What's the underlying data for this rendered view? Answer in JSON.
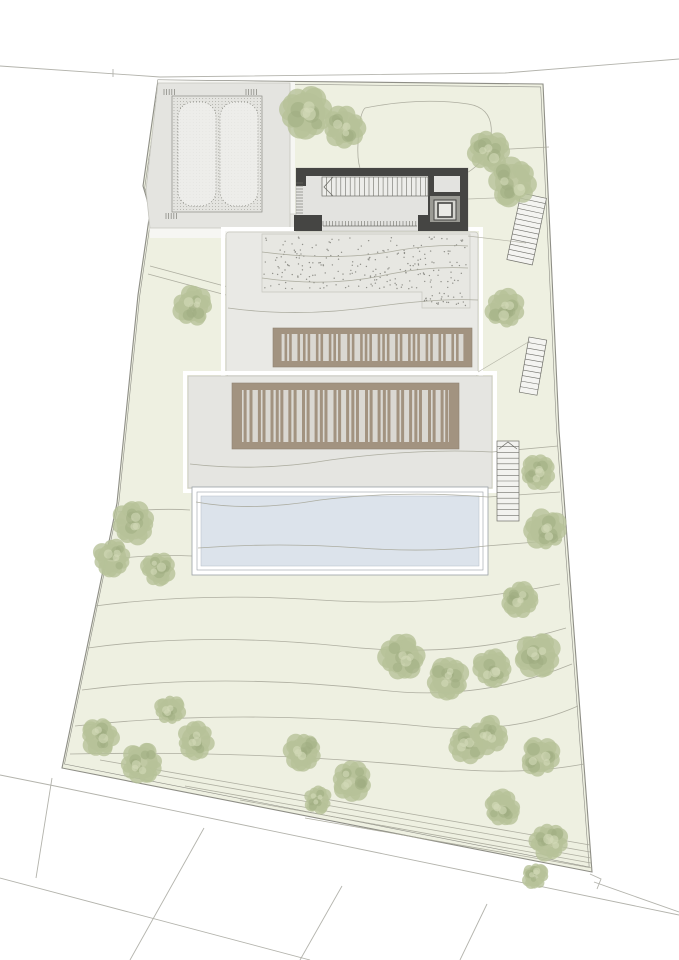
{
  "title": "architectural-site-plan",
  "canvas": {
    "width": 679,
    "height": 960
  },
  "seed": 7,
  "palette": {
    "paper": "#ffffff",
    "lawn": "#eef0e1",
    "hardscape": "#f6f6f3",
    "boundary": "#8e8e86",
    "contour": "#a6a699",
    "road": "#b3b3ac",
    "terrace": "#e9e9e5",
    "terraceB": "#e5e5e1",
    "terraceStroke": "#c6c6bf",
    "stippleDot": "#90908a",
    "parkingFill": "#e4e4e0",
    "parkingLine": "#8c8c85",
    "deckFrame": "#a29380",
    "deckBed": "#dad8d2",
    "poolFill": "#dce3eb",
    "poolLine": "#9aa0a6",
    "wall": "#454543",
    "floor": "#e3e3e0",
    "detail": "#70706a",
    "treeMid": "#b7c298",
    "treeDark": "#9dac7f",
    "treeLight": "#d3dbb9"
  },
  "site": {
    "boundary": [
      [
        158,
        80
      ],
      [
        543,
        84
      ],
      [
        551,
        255
      ],
      [
        559,
        430
      ],
      [
        572,
        605
      ],
      [
        592,
        872
      ],
      [
        62,
        768
      ],
      [
        117,
        503
      ],
      [
        138,
        295
      ],
      [
        150,
        212
      ],
      [
        146,
        196
      ],
      [
        143,
        186
      ]
    ],
    "innerScale": 0.99
  },
  "roads": {
    "top": [
      "M0,66 L160,77 L505,73 L679,59",
      "M113,69 L113,77"
    ],
    "bottom": [
      "M0,775 L50,785 L679,915",
      "M0,878 L310,960",
      "M52,778 L36,878",
      "M204,828 L130,960",
      "M342,886 L300,960",
      "M487,904 L460,960",
      "M594,882 L679,912",
      "M590,874 L601,879 L597,889"
    ]
  },
  "hardscapeZone": [
    [
      146,
      186
    ],
    [
      158,
      80
    ],
    [
      295,
      82
    ],
    [
      295,
      238
    ],
    [
      150,
      238
    ]
  ],
  "parking": {
    "platform": [
      [
        158,
        83
      ],
      [
        290,
        83
      ],
      [
        290,
        228
      ],
      [
        150,
        228
      ],
      [
        146,
        190
      ]
    ],
    "grid": {
      "x": 172,
      "y": 96,
      "w": 90,
      "h": 116,
      "step": 3.2
    },
    "beds": [
      [
        178,
        102,
        38,
        104
      ],
      [
        220,
        102,
        38,
        104
      ]
    ],
    "combs": [
      {
        "x": 164,
        "y": 89,
        "n": 5
      },
      {
        "x": 246,
        "y": 89,
        "n": 5
      },
      {
        "x": 166,
        "y": 213,
        "n": 5
      }
    ]
  },
  "connector": {
    "x": 262,
    "y": 214,
    "w": 34,
    "h": 16
  },
  "terraceA": {
    "x": 226,
    "y": 232,
    "w": 252,
    "h": 144
  },
  "stipple": {
    "poly": [
      [
        262,
        234
      ],
      [
        470,
        234
      ],
      [
        470,
        308
      ],
      [
        422,
        308
      ],
      [
        422,
        292
      ],
      [
        262,
        292
      ]
    ],
    "rects": [
      [
        264,
        237,
        202,
        52,
        230
      ],
      [
        424,
        293,
        42,
        13,
        26
      ]
    ]
  },
  "terraceB": {
    "x": 188,
    "y": 376,
    "w": 304,
    "h": 112
  },
  "decks": [
    {
      "x": 273,
      "y": 328,
      "w": 199,
      "h": 39,
      "frame": 6,
      "slatW": 2.6,
      "slats": [
        0,
        0.03,
        0.055,
        0.1,
        0.13,
        0.155,
        0.2,
        0.225,
        0.27,
        0.295,
        0.32,
        0.37,
        0.395,
        0.44,
        0.465,
        0.49,
        0.535,
        0.56,
        0.585,
        0.63,
        0.655,
        0.7,
        0.725,
        0.75,
        0.795,
        0.82,
        0.865,
        0.89,
        0.935,
        0.96,
        1
      ]
    },
    {
      "x": 232,
      "y": 383,
      "w": 227,
      "h": 66,
      "frame": 7,
      "slatW": 3,
      "slats": [
        0,
        0.022,
        0.05,
        0.09,
        0.112,
        0.15,
        0.175,
        0.197,
        0.235,
        0.26,
        0.3,
        0.322,
        0.36,
        0.385,
        0.407,
        0.45,
        0.472,
        0.51,
        0.535,
        0.557,
        0.6,
        0.622,
        0.66,
        0.685,
        0.707,
        0.75,
        0.772,
        0.81,
        0.835,
        0.857,
        0.9,
        0.922,
        0.96,
        0.982,
        1
      ]
    }
  ],
  "pool": {
    "outer": [
      192,
      487,
      296,
      88
    ],
    "mid": [
      197,
      492,
      286,
      78
    ],
    "fill": [
      201,
      496,
      278,
      70
    ]
  },
  "poolStair": {
    "x": 497,
    "y": 441,
    "w": 22,
    "h": 80,
    "rungs": 13
  },
  "boundaryStairs": [
    {
      "x": 521,
      "y": 193,
      "w": 26,
      "h": 68,
      "angle": 12,
      "steps": 13
    },
    {
      "x": 529,
      "y": 337,
      "w": 18,
      "h": 56,
      "angle": 10,
      "steps": 10
    }
  ],
  "building": {
    "x": 296,
    "y": 168,
    "w": 172,
    "h": 63,
    "blocks": [
      [
        296,
        168,
        172,
        8
      ],
      [
        460,
        168,
        8,
        63
      ],
      [
        296,
        168,
        10,
        18
      ],
      [
        294,
        215,
        28,
        16
      ],
      [
        418,
        215,
        50,
        16
      ],
      [
        428,
        176,
        6,
        40
      ],
      [
        430,
        192,
        30,
        5
      ]
    ],
    "stair": {
      "x": 322,
      "y": 177,
      "w": 106,
      "h": 19,
      "step": 4.7
    },
    "arrow": "333,177 324,187 333,196",
    "glazing": {
      "x1": 323,
      "x2": 417,
      "y1": 221,
      "y2": 226,
      "step": 3.2
    },
    "leftTicks": {
      "x1": 296,
      "x2": 303,
      "y1": 183,
      "y2": 213,
      "step": 3
    },
    "liftPad": [
      430,
      196,
      30,
      26
    ],
    "liftOuter": [
      434,
      200,
      22,
      20
    ],
    "liftInner": [
      438,
      203,
      14,
      14
    ]
  },
  "pathsLines": [
    "M468,199 L521,197",
    "M468,236 L526,243",
    "M478,372 L530,341"
  ],
  "contoursUnder": [
    "M150,266 L228,287",
    "M148,274 L226,295",
    "M95,606 Q200,592 320,600 Q440,608 560,584",
    "M88,648 Q200,632 340,646 Q460,660 566,628",
    "M82,690 Q220,672 380,690 Q480,702 572,664",
    "M75,726 Q240,708 420,726 Q510,736 578,706",
    "M70,754 Q260,750 440,768 Q520,776 584,764",
    "M100,760 L590,845",
    "M140,772 L590,852",
    "M185,786 L591,858",
    "M240,800 L591,863",
    "M305,818 L592,868",
    "M365,108 Q420,97 468,104 Q494,108 491,136 Q489,166 452,180 Q408,193 374,186 Q356,178 358,144 Q359,114 365,108",
    "M491,150 L549,147",
    "M118,512 Q160,508 190,510",
    "M104,560 Q150,554 192,556"
  ],
  "contoursOver": [
    "M262,252 Q340,262 400,250 Q436,244 468,246",
    "M262,278 Q330,288 390,274 Q430,266 468,268",
    "M228,308 Q300,318 380,306 Q440,298 478,300",
    "M190,464 Q260,472 330,460 Q420,448 492,452 L558,446",
    "M196,502 Q250,512 320,500 Q400,490 488,497 L560,492",
    "M198,548 Q280,542 360,548 Q430,553 486,546 L562,540"
  ],
  "trees": [
    [
      306,
      112,
      27
    ],
    [
      344,
      127,
      22
    ],
    [
      489,
      151,
      22
    ],
    [
      513,
      182,
      25
    ],
    [
      193,
      306,
      21
    ],
    [
      505,
      309,
      21
    ],
    [
      538,
      472,
      19
    ],
    [
      546,
      530,
      22
    ],
    [
      520,
      600,
      19
    ],
    [
      538,
      655,
      24
    ],
    [
      402,
      657,
      24
    ],
    [
      448,
      679,
      22
    ],
    [
      492,
      668,
      20
    ],
    [
      468,
      744,
      21
    ],
    [
      133,
      523,
      23
    ],
    [
      112,
      558,
      20
    ],
    [
      158,
      569,
      18
    ],
    [
      100,
      737,
      20
    ],
    [
      142,
      763,
      22
    ],
    [
      196,
      740,
      20
    ],
    [
      170,
      710,
      16
    ],
    [
      303,
      752,
      20
    ],
    [
      352,
      781,
      21
    ],
    [
      318,
      800,
      15
    ],
    [
      489,
      735,
      20
    ],
    [
      540,
      757,
      21
    ],
    [
      502,
      808,
      19
    ],
    [
      549,
      842,
      20
    ],
    [
      535,
      876,
      14
    ]
  ]
}
